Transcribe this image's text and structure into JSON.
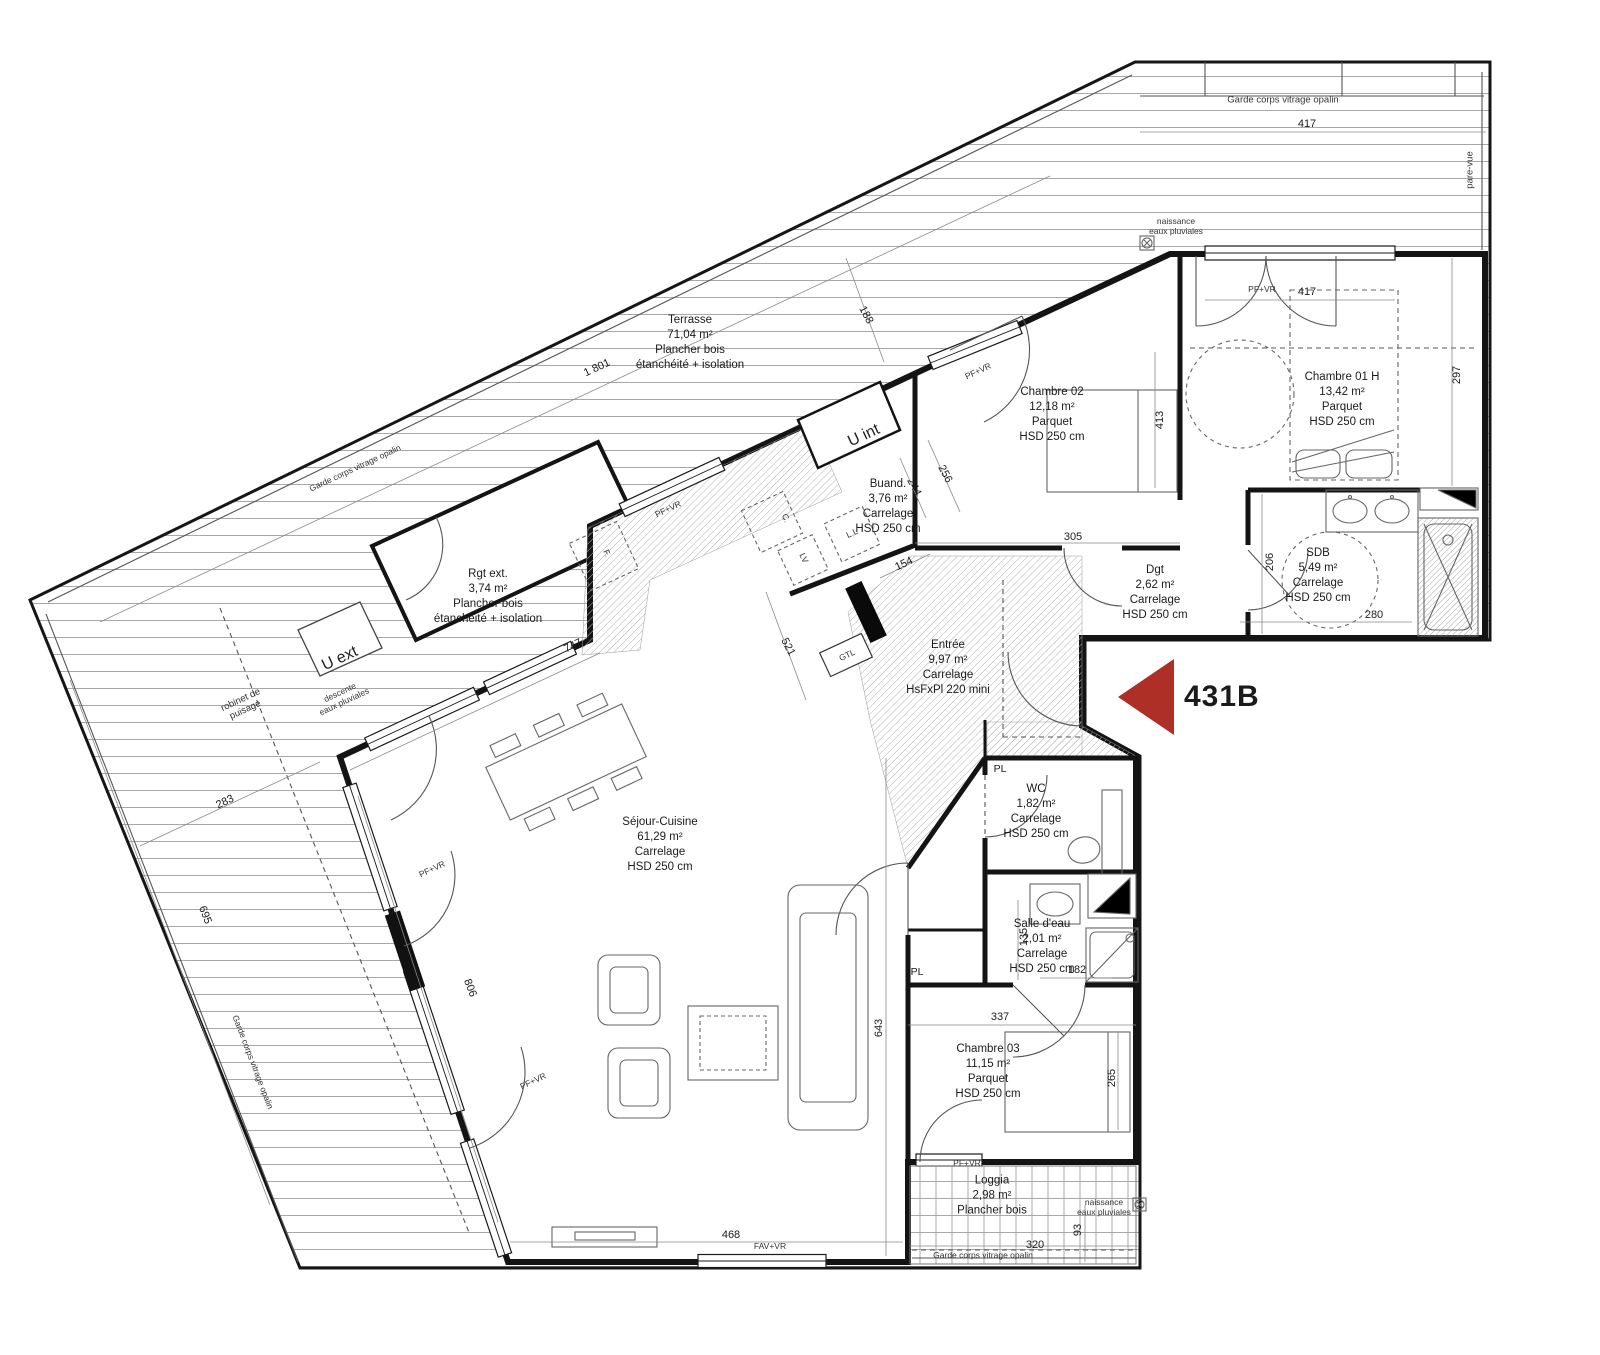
{
  "meta": {
    "unit": "431B"
  },
  "colors": {
    "marker_red": "#AD2F26"
  },
  "rooms": {
    "terrasse": {
      "name": "Terrasse",
      "area": "71,04 m²",
      "floor": "Plancher bois",
      "note": "étanchéité + isolation"
    },
    "rgt_ext": {
      "name": "Rgt ext.",
      "area": "3,74 m²",
      "floor": "Plancher bois",
      "note": "étanchéité + isolation"
    },
    "buanderie": {
      "name": "Buand.",
      "area": "3,76 m²",
      "floor": "Carrelage",
      "note": "HSD 250 cm"
    },
    "chambre02": {
      "name": "Chambre 02",
      "area": "12,18 m²",
      "floor": "Parquet",
      "note": "HSD 250 cm"
    },
    "chambre01": {
      "name": "Chambre 01 H",
      "area": "13,42 m²",
      "floor": "Parquet",
      "note": "HSD 250 cm"
    },
    "sdb": {
      "name": "SDB",
      "area": "5,49 m²",
      "floor": "Carrelage",
      "note": "HSD 250 cm"
    },
    "dgt": {
      "name": "Dgt",
      "area": "2,62 m²",
      "floor": "Carrelage",
      "note": "HSD 250 cm"
    },
    "entree": {
      "name": "Entrée",
      "area": "9,97 m²",
      "floor": "Carrelage",
      "note": "HsFxPl 220 mini"
    },
    "wc": {
      "name": "WC",
      "area": "1,82 m²",
      "floor": "Carrelage",
      "note": "HSD 250 cm"
    },
    "salle_deau": {
      "name": "Salle d'eau",
      "area": "2,01 m²",
      "floor": "Carrelage",
      "note": "HSD 250 cm"
    },
    "sejour": {
      "name": "Séjour-Cuisine",
      "area": "61,29 m²",
      "floor": "Carrelage",
      "note": "HSD 250 cm"
    },
    "chambre03": {
      "name": "Chambre 03",
      "area": "11,15 m²",
      "floor": "Parquet",
      "note": "HSD 250 cm"
    },
    "loggia": {
      "name": "Loggia",
      "area": "2,98 m²",
      "floor": "Plancher bois"
    }
  },
  "dims": {
    "terrace_length": "1 801",
    "terrace_width": "188",
    "terrace_rail": "417",
    "ch01_width": "417",
    "ch01_depth": "297",
    "ch02_depth": "413",
    "ch02_width": "305",
    "buand_w": "244",
    "buand_h": "256",
    "buand_door": "154",
    "sdb_depth": "206",
    "sdb_width": "280",
    "sejour_nw": "747",
    "kitchen": "521",
    "terrace_left": "283",
    "terrace_side": "695",
    "sejour_sw": "806",
    "sejour_e": "643",
    "sejour_s": "468",
    "ch03_width": "337",
    "ch03_depth": "265",
    "sde_w": "135",
    "sde_l": "182",
    "loggia_w": "320",
    "loggia_d": "93"
  },
  "labels": {
    "u_int": "U int",
    "u_ext": "U ext",
    "gtl": "GTL",
    "pl": "PL",
    "ll": "L.L",
    "lv": "LV",
    "c": "C.",
    "f": "F.",
    "pf_vr": "PF+VR",
    "fav_vr": "FAV+VR",
    "garde_corps": "Garde corps vitrage opalin",
    "pare_vue": "pare-vue",
    "naissance": "naissance\neaux pluviales",
    "descente": "descente\neaux pluviales",
    "robinet": "robinet de\npuisage"
  }
}
